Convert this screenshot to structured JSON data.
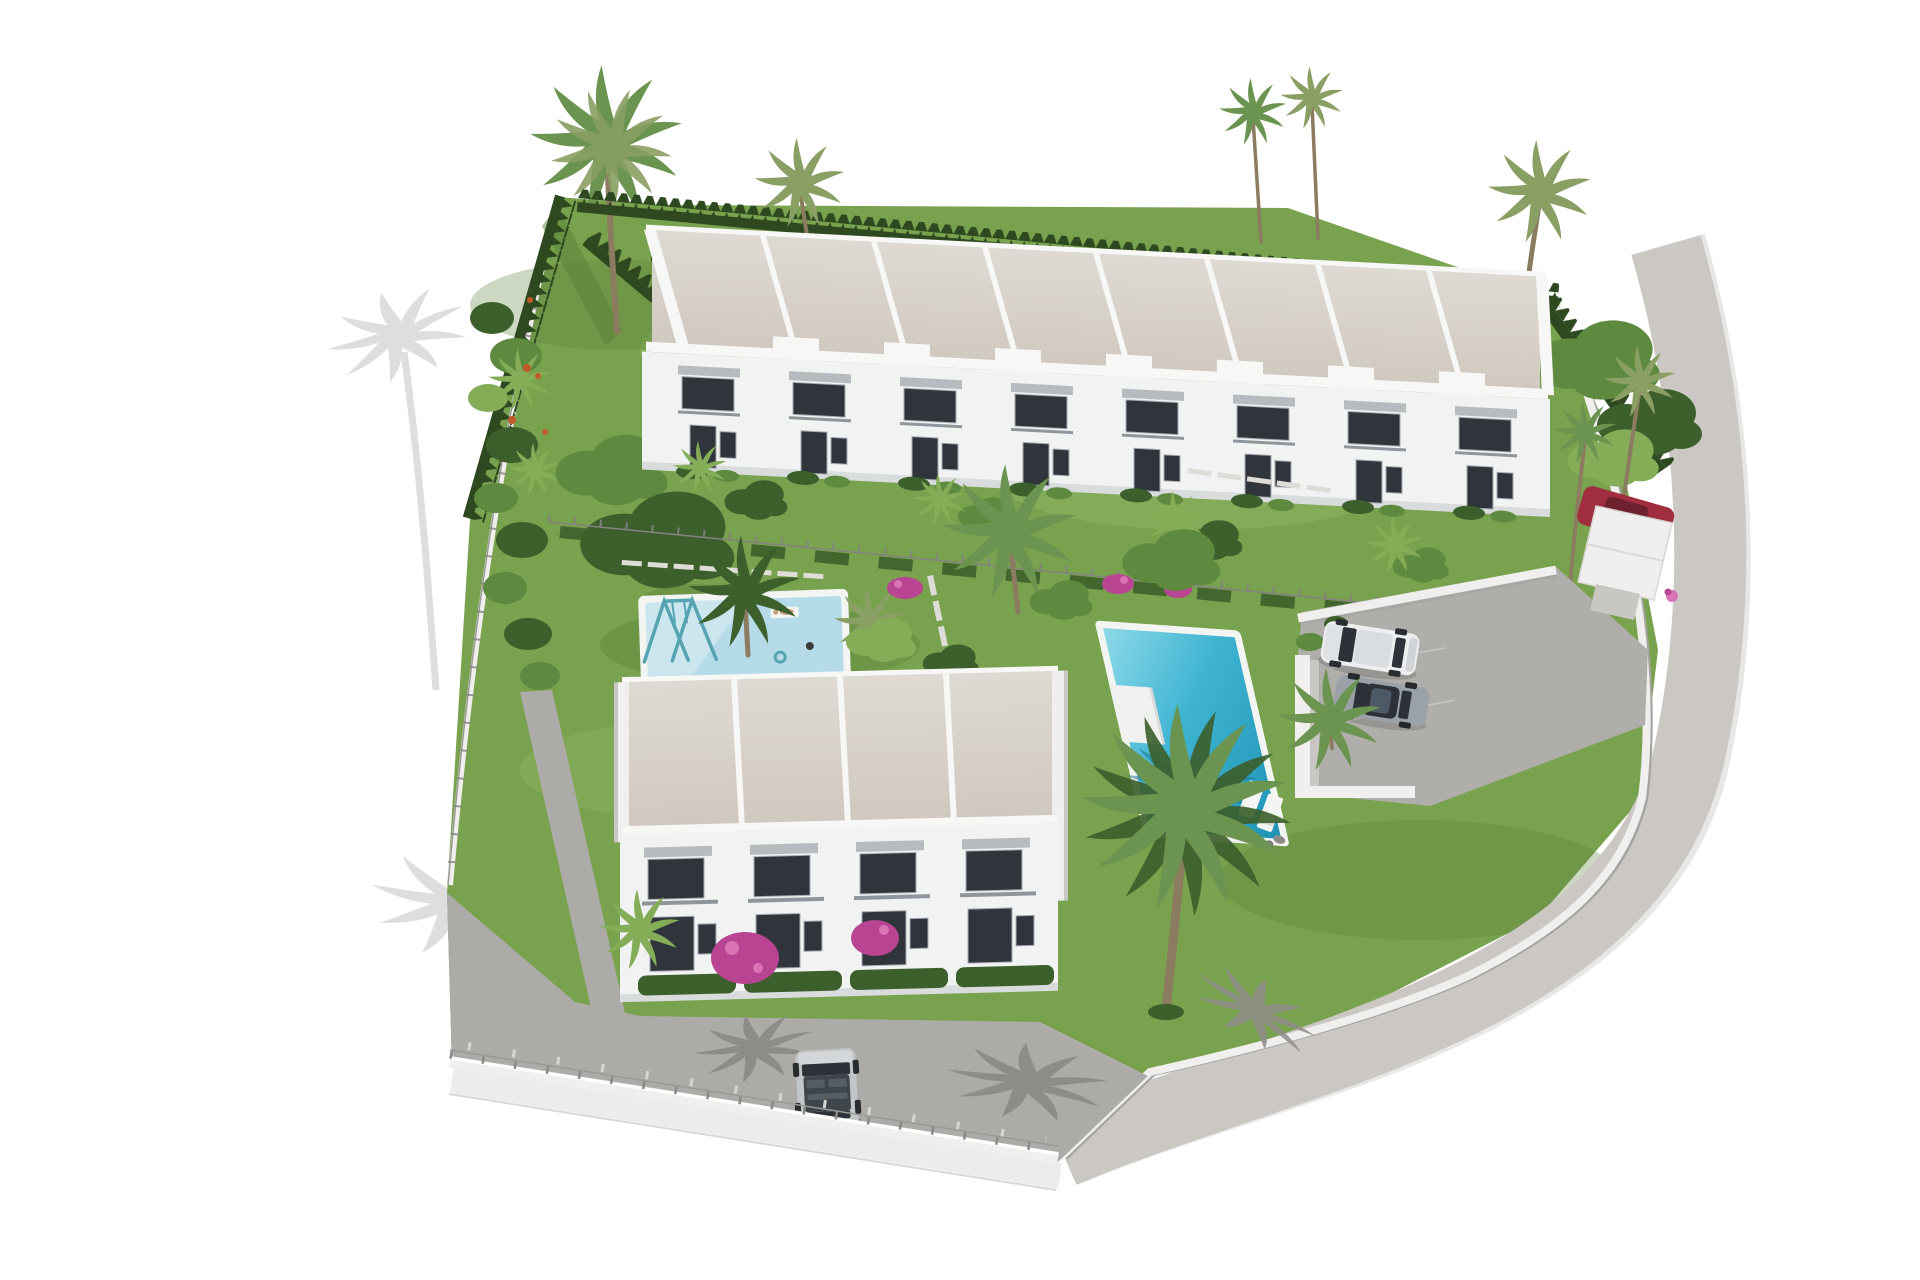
{
  "scene": {
    "type": "architectural-3d-render",
    "description": "Aerial 3D render of a white Mediterranean townhouse development: a long row of eight flat-roofed townhouses at the top, a block of four townhouses below, landscaped gardens with palm trees and cypress hedges, a small children's pool with a swing set, a large turquoise swimming pool with sun loungers, a parking area with two cars, an entrance canopy with a red car, a curved perimeter road, and a street with a parked silver car",
    "lighting": "bright sunlight, hard shadows, white blown-out background"
  },
  "colors": {
    "bg": "#ffffff",
    "lawn": "#79a24e",
    "lawnLight": "#92b765",
    "lawnDark": "#5a7f38",
    "hedge": "#2e481f",
    "foliage": "#5d8a3e",
    "foliageLight": "#85ad58",
    "foliageDark": "#3c5f2b",
    "palmGreen": "#6b9450",
    "palmOlive": "#8a9f63",
    "trunk": "#8b7b5f",
    "roofBeige": "#cfc8bf",
    "roofBeigeLight": "#dedad3",
    "parapet": "#f7f7f5",
    "facade": "#f1f2f2",
    "facadeShade": "#d9dcdd",
    "windowDark": "#2f353b",
    "awning": "#b6bbbf",
    "rail": "#8f969b",
    "kidsWater": "#b5dbe9",
    "kidsWaterLight": "#d8edf4",
    "poolWaterLight": "#8ed9e8",
    "poolWater": "#3eb4d2",
    "poolWaterDark": "#1f93b4",
    "poolDeck": "#eff1ee",
    "coping": "#f3f5f2",
    "parking": "#b0aeaa",
    "road": "#cbc8c4",
    "roadKerb": "#e8e7e5",
    "wallWhite": "#f0efed",
    "wallShade": "#c9c7c4",
    "pavement": "#adaba7",
    "pavementShadow": "#8e8c88",
    "shadowOnWhite": "#dedede",
    "fence": "#83837f",
    "carWhite": "#eceef0",
    "carGrey": "#9aa1a7",
    "carSilver": "#c3c6c8",
    "carRed": "#a02e3e",
    "carGlass": "#2c3238",
    "bougainvillea": "#b94592",
    "bougainvilleaLight": "#d973b4",
    "flowerOrange": "#c05a2a",
    "slab": "#dedcd7",
    "swing": "#56a3b2",
    "skin": "#c79e78"
  },
  "objects": {
    "top_townhouse_row": {
      "units": 8,
      "floors": 2,
      "roof": "flat beige gravel roofs with white parapets",
      "facade": "white with dark glazing, grey awnings and balconies"
    },
    "bottom_townhouse_block": {
      "units": 4,
      "floors": 2,
      "features": [
        "balconies",
        "bougainvillea",
        "front hedges"
      ]
    },
    "kids_pool": {
      "shape": "rectangle",
      "water": "light blue",
      "features": [
        "swing set",
        "sunbathers",
        "swim ring"
      ]
    },
    "main_pool": {
      "shape": "rectangle",
      "water": "turquoise",
      "features": [
        "white deck platform",
        "two sun loungers",
        "palm shadow on water"
      ]
    },
    "parking_area": {
      "surface": "grey",
      "cars": [
        "white suv",
        "grey sedan"
      ],
      "features": [
        "white boundary walls",
        "palm tree"
      ]
    },
    "entrance": {
      "features": [
        "white canopy",
        "red car"
      ]
    },
    "street": {
      "surface": "grey pavement",
      "cars": [
        "silver hatchback"
      ],
      "features": [
        "white wall with wire fence",
        "palm shadows"
      ]
    },
    "perimeter_road": {
      "shape": "curved",
      "edges": [
        "white retaining wall",
        "white kerb"
      ]
    },
    "vegetation": {
      "palm_trees": 14,
      "cypress_hedges": true,
      "bougainvillea_clusters": 5,
      "tropical_shrub_border": "west side"
    },
    "shadows_on_white_ground": 2
  }
}
